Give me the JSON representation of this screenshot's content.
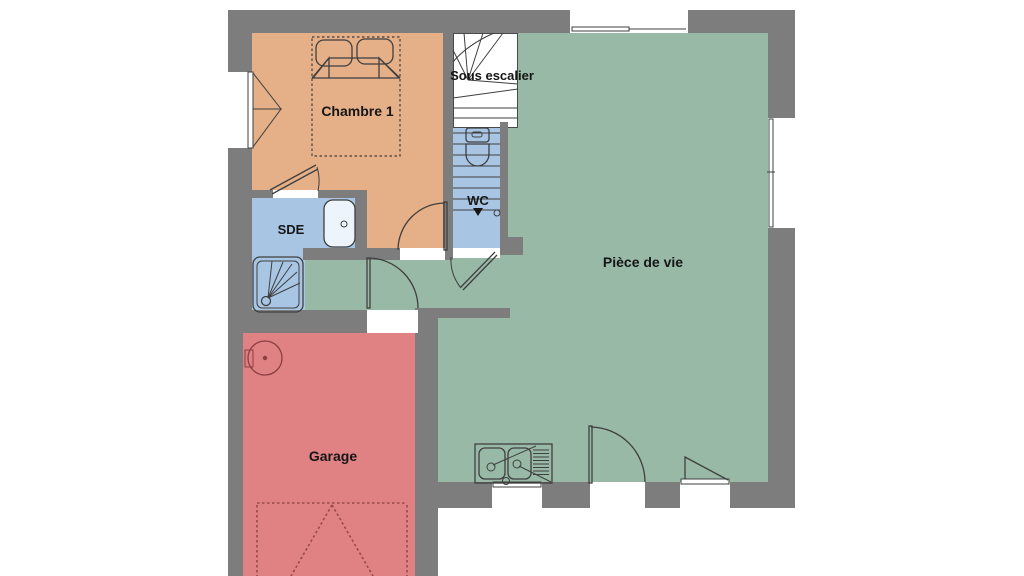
{
  "plan": {
    "type": "floor-plan",
    "rooms": {
      "bedroom": {
        "label": "Chambre 1",
        "color": "#e5af87"
      },
      "shower_room": {
        "label": "SDE",
        "color": "#a8c6e4"
      },
      "wc": {
        "label": "WC",
        "color": "#a8c6e4"
      },
      "under_stairs": {
        "label": "Sous escalier",
        "color": "#ffffff"
      },
      "living_room": {
        "label": "Pièce de vie",
        "color": "#98b9a6"
      },
      "garage": {
        "label": "Garage",
        "color": "#e08184"
      }
    },
    "fixtures": [
      "double-bed",
      "staircase",
      "toilet",
      "bathtub",
      "shower-tray",
      "kitchen-sink",
      "water-heater",
      "garage-door"
    ],
    "colors": {
      "wall": "#7d7d7d",
      "outline": "#3f3f3f",
      "garage_door_dash": "#9a4a4a",
      "background": "#ffffff"
    }
  }
}
